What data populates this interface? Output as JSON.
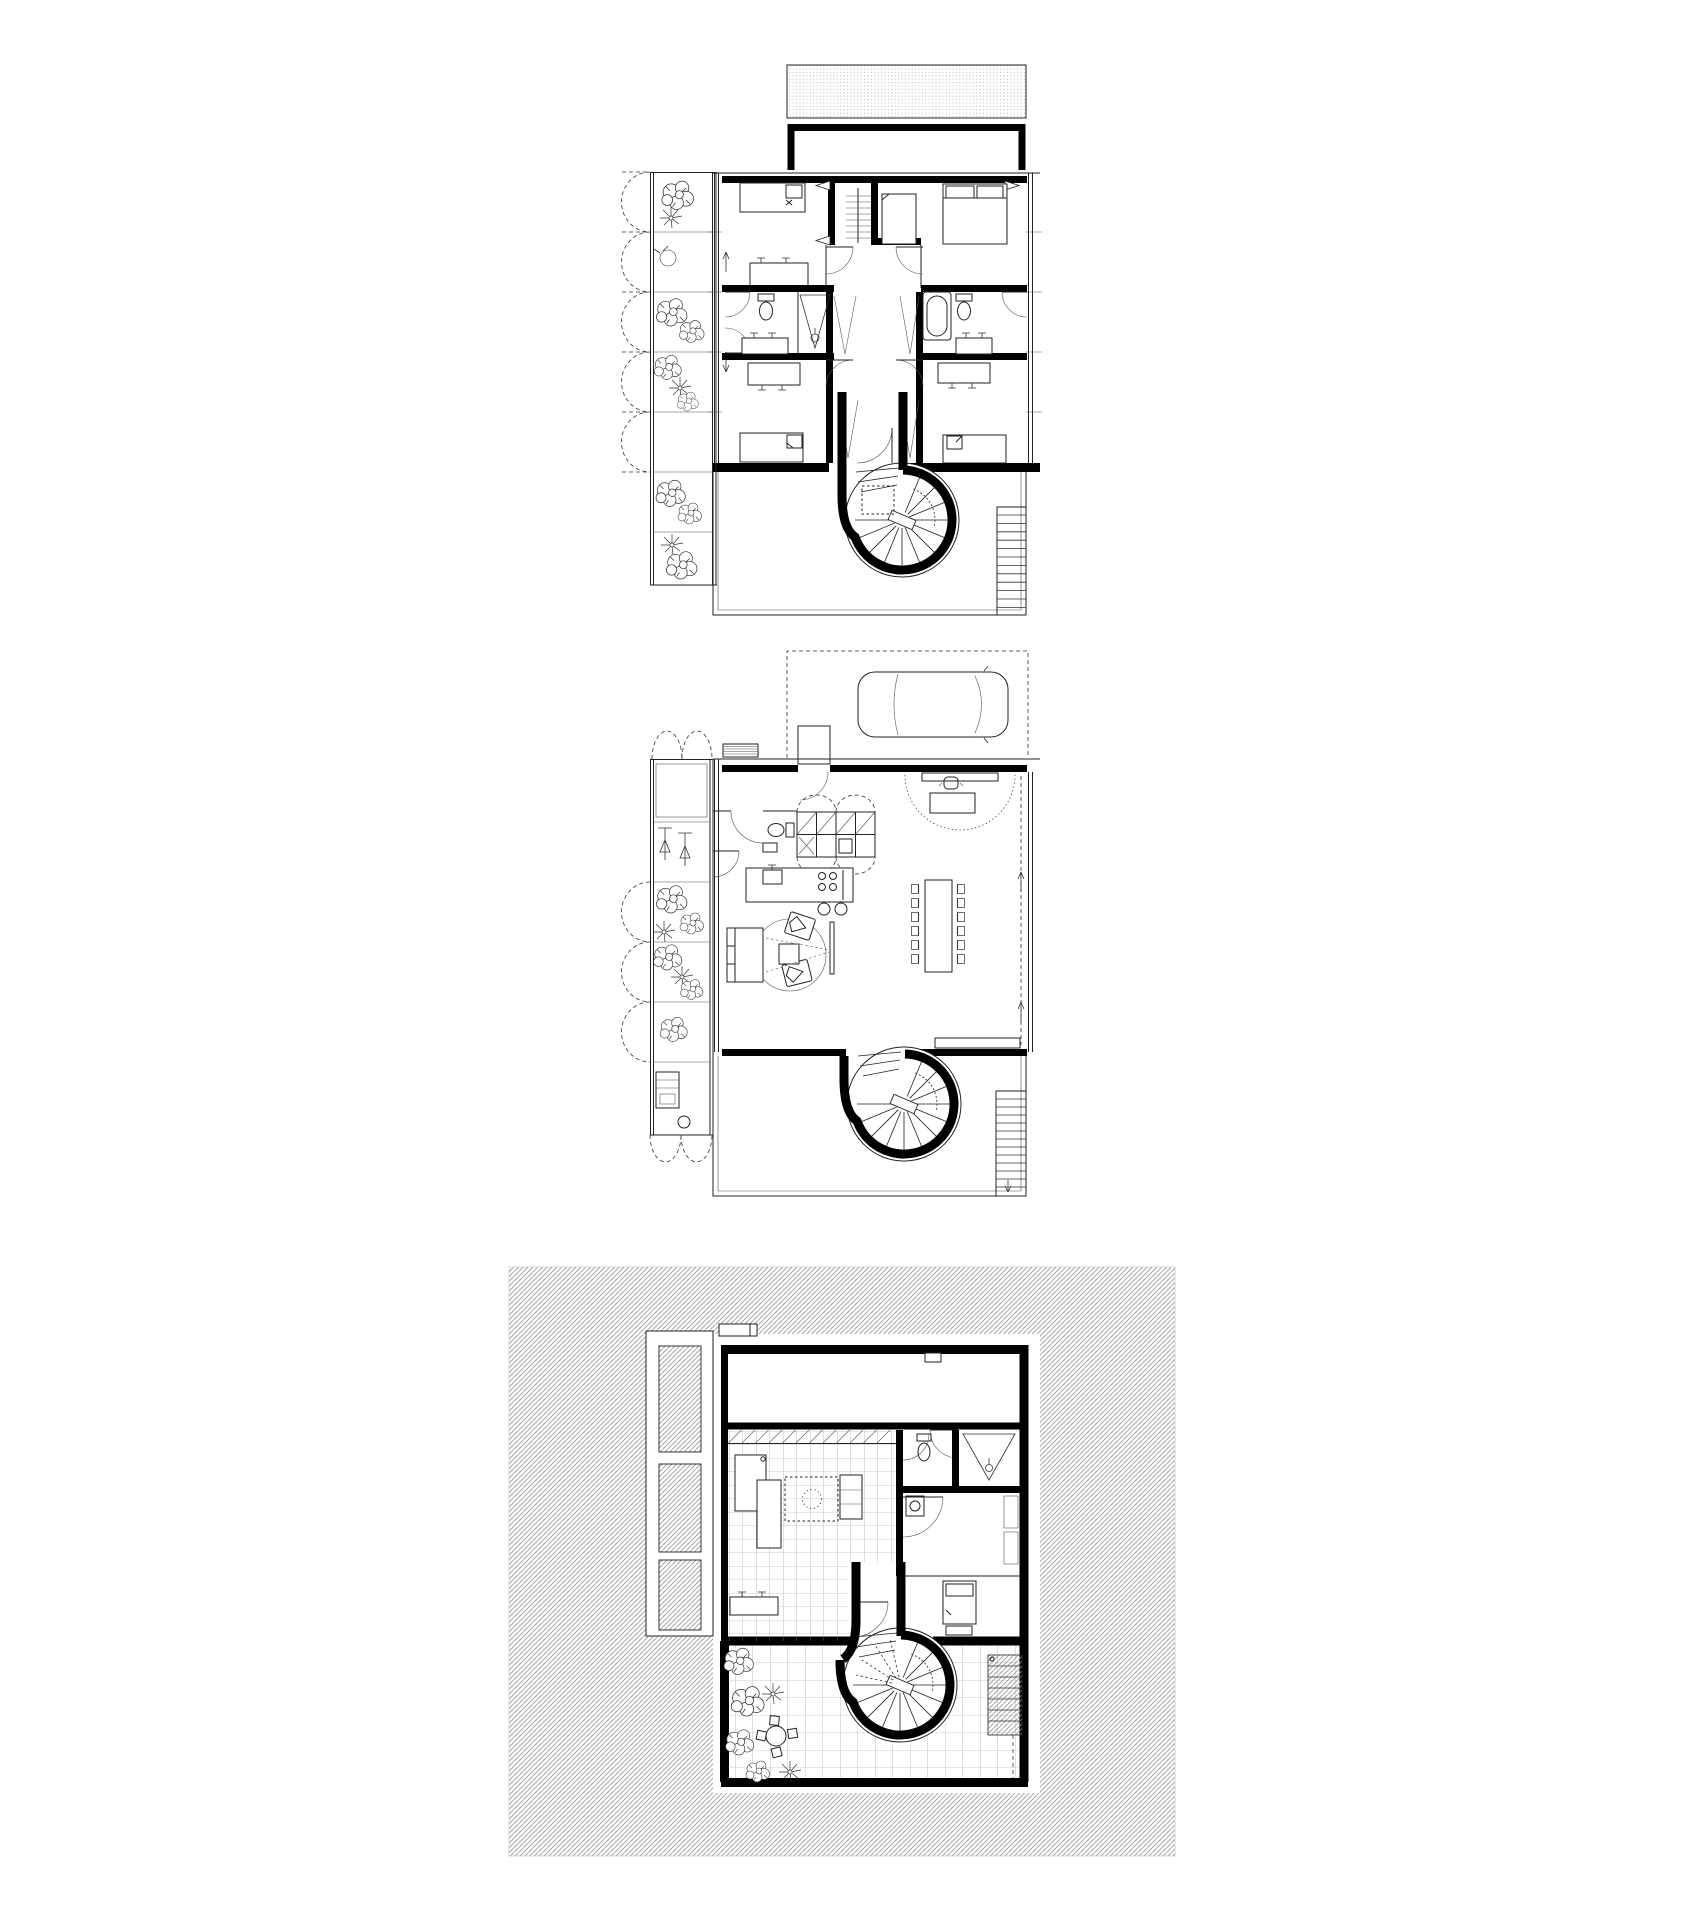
{
  "sheet": {
    "title": "Residential architecture drawing — three stacked floor plans",
    "drawing_type": "black and white architectural line drawing",
    "background": "#ffffff"
  },
  "colors": {
    "line": "#222222",
    "wall": "#000000",
    "site_hatch_line": "#8f8f8f",
    "tile_grid_line": "#888888",
    "roof_texture": "#aaaaaa",
    "paper": "#ffffff"
  },
  "plans": [
    {
      "id": "upper-floor-plan",
      "name": "Upper floor plan: roof terrace with textured canopy, planted balcony strip with scalloped awnings, two upper bedrooms with wardrobe core, two bathrooms (toilet, shower, bathtub, vanities), two lower bedrooms, central corridor funnelling into a spiral staircase, rear terrace with exterior ladder stair"
    },
    {
      "id": "ground-floor-plan",
      "name": "Ground floor plan: dashed carport with car, entry steps and door, WC, kitchen wall units and cooking island with stools, study nook with dotted arc, long dining table with twelve chairs, living area with sofa, armchairs and round rug, conservatory / planted strip, spiral staircase, rear terrace with exterior ladder stair"
    },
    {
      "id": "garden-level-plan",
      "name": "Garden level plan: diagonally hatched site square, three hatched planter beds, storage room, tiled utility room, small bathroom with shower, bedroom, spiral staircase landing on a paved patio with plants, round table and exterior step flight"
    }
  ]
}
